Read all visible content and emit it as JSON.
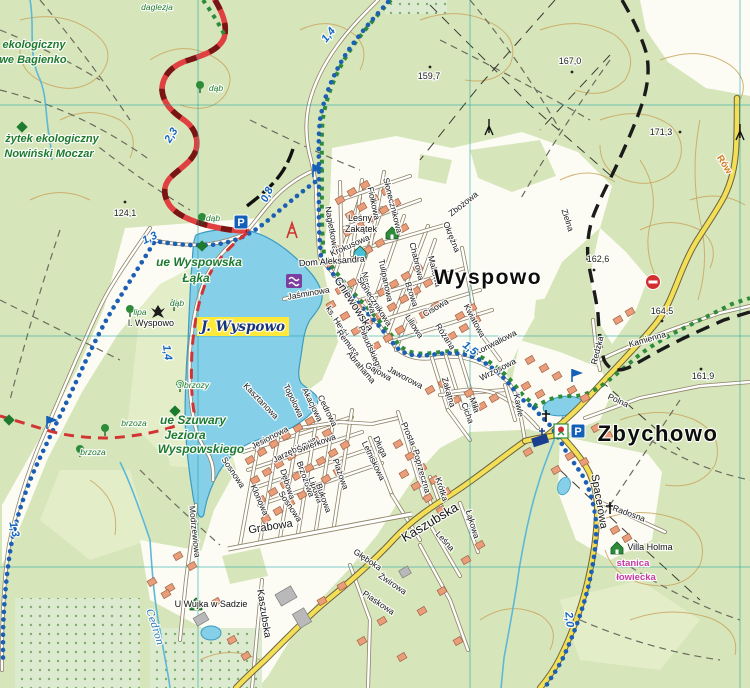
{
  "towns": [
    {
      "name": "Wyspowo",
      "x": 488,
      "y": 284,
      "fs": 21
    },
    {
      "name": "Zbychowo",
      "x": 658,
      "y": 441,
      "fs": 22
    }
  ],
  "streets": [
    {
      "n": "Zbożowa",
      "x": 465,
      "y": 206,
      "r": -38
    },
    {
      "n": "Okrężna",
      "x": 449,
      "y": 238,
      "r": 68
    },
    {
      "n": "Zielna",
      "x": 565,
      "y": 221,
      "r": 72
    },
    {
      "n": "Słonecznikowa",
      "x": 390,
      "y": 206,
      "r": 76
    },
    {
      "n": "Fiołkowa",
      "x": 371,
      "y": 204,
      "r": 78
    },
    {
      "n": "Nagietkowa",
      "x": 329,
      "y": 229,
      "r": 80
    },
    {
      "n": "Krokusowa",
      "x": 351,
      "y": 248,
      "r": -24
    },
    {
      "n": "Chabrowa",
      "x": 414,
      "y": 262,
      "r": 76
    },
    {
      "n": "Makowa",
      "x": 432,
      "y": 272,
      "r": 76
    },
    {
      "n": "Tulipanowa",
      "x": 383,
      "y": 281,
      "r": 78
    },
    {
      "n": "Narcyzowa",
      "x": 366,
      "y": 293,
      "r": 78
    },
    {
      "n": "Bzowa",
      "x": 409,
      "y": 295,
      "r": 72
    },
    {
      "n": "Gniewowska",
      "x": 351,
      "y": 306,
      "r": 57,
      "fs": 11
    },
    {
      "n": "Słonecznikowa",
      "x": 372,
      "y": 303,
      "r": 57
    },
    {
      "n": "Jaśminowa",
      "x": 309,
      "y": 296,
      "r": -10
    },
    {
      "n": "ks. Heyki",
      "x": 335,
      "y": 323,
      "r": 57
    },
    {
      "n": "Piłsudskiego",
      "x": 368,
      "y": 349,
      "r": 66
    },
    {
      "n": "Remusa",
      "x": 346,
      "y": 345,
      "r": 52
    },
    {
      "n": "Abrahama",
      "x": 359,
      "y": 369,
      "r": 50
    },
    {
      "n": "Gajowa",
      "x": 377,
      "y": 374,
      "r": 30
    },
    {
      "n": "Jaworowa",
      "x": 404,
      "y": 380,
      "r": 28
    },
    {
      "n": "Cisowa",
      "x": 437,
      "y": 310,
      "r": -30
    },
    {
      "n": "Liliowa",
      "x": 412,
      "y": 328,
      "r": 57
    },
    {
      "n": "Różana",
      "x": 443,
      "y": 338,
      "r": 57
    },
    {
      "n": "Kwiatowa",
      "x": 472,
      "y": 322,
      "r": 62
    },
    {
      "n": "Konwaliowa",
      "x": 497,
      "y": 345,
      "r": -27
    },
    {
      "n": "Wrzosowa",
      "x": 499,
      "y": 372,
      "r": -27
    },
    {
      "n": "Zakątna",
      "x": 446,
      "y": 393,
      "r": 74
    },
    {
      "n": "Miła",
      "x": 472,
      "y": 406,
      "r": 70
    },
    {
      "n": "Cicha",
      "x": 465,
      "y": 414,
      "r": 70
    },
    {
      "n": "Kawle",
      "x": 516,
      "y": 406,
      "r": 78
    },
    {
      "n": "Kasztanowa",
      "x": 259,
      "y": 403,
      "r": 46
    },
    {
      "n": "Topolowa",
      "x": 291,
      "y": 402,
      "r": 64
    },
    {
      "n": "Akacjowa",
      "x": 310,
      "y": 406,
      "r": 64
    },
    {
      "n": "Cedrowa",
      "x": 325,
      "y": 412,
      "r": 64
    },
    {
      "n": "Jesionowa",
      "x": 271,
      "y": 440,
      "r": -27
    },
    {
      "n": "Jarzębinowa",
      "x": 296,
      "y": 452,
      "r": -27
    },
    {
      "n": "Świerkowa",
      "x": 317,
      "y": 446,
      "r": -20
    },
    {
      "n": "Sosnowa",
      "x": 231,
      "y": 474,
      "r": 56
    },
    {
      "n": "Klonowa",
      "x": 257,
      "y": 501,
      "r": 66
    },
    {
      "n": "Dębowa",
      "x": 285,
      "y": 485,
      "r": 72
    },
    {
      "n": "Brzozowa",
      "x": 303,
      "y": 480,
      "r": 70
    },
    {
      "n": "Lipowa",
      "x": 313,
      "y": 491,
      "r": 70
    },
    {
      "n": "Bukowa",
      "x": 321,
      "y": 499,
      "r": 70
    },
    {
      "n": "Plażowa",
      "x": 338,
      "y": 475,
      "r": 70
    },
    {
      "n": "Sosnowa",
      "x": 288,
      "y": 508,
      "r": 56
    },
    {
      "n": "Grabowa",
      "x": 271,
      "y": 530,
      "r": -9,
      "fs": 11
    },
    {
      "n": "Modrzewiowa",
      "x": 192,
      "y": 532,
      "r": 84
    },
    {
      "n": "Długa",
      "x": 378,
      "y": 448,
      "r": 64
    },
    {
      "n": "Letniskowa",
      "x": 371,
      "y": 462,
      "r": 64
    },
    {
      "n": "Prosta",
      "x": 406,
      "y": 435,
      "r": 66
    },
    {
      "n": "Poprzeczna",
      "x": 419,
      "y": 472,
      "r": 74
    },
    {
      "n": "Krótka",
      "x": 439,
      "y": 490,
      "r": 72
    },
    {
      "n": "Kaszubska",
      "x": 432,
      "y": 526,
      "r": -31,
      "fs": 13
    },
    {
      "n": "Łąkowa",
      "x": 470,
      "y": 525,
      "r": 73
    },
    {
      "n": "Leśna",
      "x": 443,
      "y": 543,
      "r": 48
    },
    {
      "n": "Kaszubska",
      "x": 261,
      "y": 614,
      "r": 81,
      "fs": 10
    },
    {
      "n": "Głęboka",
      "x": 366,
      "y": 562,
      "r": 34
    },
    {
      "n": "Żwirowa",
      "x": 391,
      "y": 586,
      "r": 34
    },
    {
      "n": "Piaskowa",
      "x": 377,
      "y": 605,
      "r": 34
    },
    {
      "n": "Spacerowa",
      "x": 596,
      "y": 502,
      "r": 80,
      "fs": 11
    },
    {
      "n": "Radosna",
      "x": 628,
      "y": 516,
      "r": 20
    },
    {
      "n": "Polna",
      "x": 617,
      "y": 403,
      "r": 24
    },
    {
      "n": "Kamienna",
      "x": 648,
      "y": 342,
      "r": -16
    },
    {
      "n": "Redzka",
      "x": 600,
      "y": 351,
      "r": -76
    }
  ],
  "nature": [
    {
      "t": "ekologiczny",
      "x": 34,
      "y": 48,
      "fs": 11
    },
    {
      "t": "we Bagienko",
      "x": 33,
      "y": 63,
      "fs": 11
    },
    {
      "t": "żytek ekologiczny",
      "x": 52,
      "y": 142,
      "fs": 11
    },
    {
      "t": "Nowiński Moczar",
      "x": 49,
      "y": 157,
      "fs": 11
    },
    {
      "t": "ue Wyspowska",
      "x": 199,
      "y": 266,
      "fs": 12
    },
    {
      "t": "Łąka",
      "x": 196,
      "y": 282,
      "fs": 12
    },
    {
      "t": "ue Szuwary",
      "x": 193,
      "y": 424,
      "fs": 12
    },
    {
      "t": "Jeziora",
      "x": 185,
      "y": 439,
      "fs": 12
    },
    {
      "t": "Wyspowskiego",
      "x": 201,
      "y": 453,
      "fs": 12
    }
  ],
  "trees": [
    {
      "t": "daglezja",
      "x": 157,
      "y": 10
    },
    {
      "t": "dąb",
      "x": 216,
      "y": 91
    },
    {
      "t": "dąb",
      "x": 213,
      "y": 221
    },
    {
      "t": "lipa",
      "x": 140,
      "y": 315
    },
    {
      "t": "dąb",
      "x": 177,
      "y": 306
    },
    {
      "t": "3 brzozy",
      "x": 193,
      "y": 388
    },
    {
      "t": "brzoza",
      "x": 134,
      "y": 426
    },
    {
      "t": "brzoza",
      "x": 93,
      "y": 455
    }
  ],
  "poi": [
    {
      "t": "Leśny",
      "x": 360,
      "y": 221
    },
    {
      "t": "Zakątek",
      "x": 361,
      "y": 232
    },
    {
      "t": "Dom Aleksandra",
      "x": 332,
      "y": 264,
      "r": -4
    },
    {
      "t": "l. Wyspowo",
      "x": 151,
      "y": 326
    },
    {
      "t": "U Wujka w Sadzie",
      "x": 211,
      "y": 607
    },
    {
      "t": "Villa Holma",
      "x": 650,
      "y": 550
    }
  ],
  "water_labels": [
    {
      "t": "J. Wyspowo",
      "x": 243,
      "y": 331,
      "bg": 1
    },
    {
      "t": "Cedron",
      "x": 152,
      "y": 628,
      "r": 72
    }
  ],
  "other_labels": [
    {
      "t": "stanica",
      "x": 633,
      "y": 566,
      "c": "#c73aa4"
    },
    {
      "t": "łowiecka",
      "x": 636,
      "y": 580,
      "c": "#c73aa4"
    },
    {
      "t": "Rów",
      "x": 722,
      "y": 166,
      "r": 58,
      "c": "#d4791f"
    }
  ],
  "heights": [
    {
      "v": "124,1",
      "x": 125,
      "y": 216,
      "dx": 0,
      "dy": -14
    },
    {
      "v": "159,7",
      "x": 429,
      "y": 79,
      "dx": 1,
      "dy": -12
    },
    {
      "v": "167,0",
      "x": 570,
      "y": 64,
      "dx": 2,
      "dy": 8
    },
    {
      "v": "171,3",
      "x": 661,
      "y": 135,
      "dx": 19,
      "dy": -3
    },
    {
      "v": "162,6",
      "x": 598,
      "y": 262,
      "dx": -4,
      "dy": 8
    },
    {
      "v": "164,5",
      "x": 662,
      "y": 314,
      "dx": 0,
      "dy": 7
    },
    {
      "v": "161,9",
      "x": 703,
      "y": 379,
      "dx": -2,
      "dy": -10
    }
  ],
  "markers": [
    {
      "v": "1,4",
      "x": 331,
      "y": 37,
      "r": -52
    },
    {
      "v": "2,3",
      "x": 174,
      "y": 137,
      "r": -58
    },
    {
      "v": "0,8",
      "x": 270,
      "y": 196,
      "r": -65
    },
    {
      "v": "1,3",
      "x": 151,
      "y": 241,
      "r": -25
    },
    {
      "v": "1,4",
      "x": 164,
      "y": 353,
      "r": 82
    },
    {
      "v": "1,5",
      "x": 468,
      "y": 351,
      "r": 38
    },
    {
      "v": "1,3",
      "x": 11,
      "y": 530,
      "r": 78
    },
    {
      "v": "2,0",
      "x": 566,
      "y": 620,
      "r": 84
    }
  ],
  "icons": [
    {
      "t": "parking",
      "x": 241,
      "y": 222
    },
    {
      "t": "parking",
      "x": 578,
      "y": 431
    },
    {
      "t": "flag",
      "x": 313,
      "y": 174
    },
    {
      "t": "flag",
      "x": 572,
      "y": 379
    },
    {
      "t": "flag",
      "x": 47,
      "y": 426
    },
    {
      "t": "swim",
      "x": 294,
      "y": 281
    },
    {
      "t": "agro",
      "x": 392,
      "y": 233
    },
    {
      "t": "agro",
      "x": 196,
      "y": 604
    },
    {
      "t": "agro",
      "x": 617,
      "y": 548
    },
    {
      "t": "hostel",
      "x": 360,
      "y": 252
    },
    {
      "t": "tower",
      "x": 292,
      "y": 231
    },
    {
      "t": "landmark",
      "x": 158,
      "y": 312
    },
    {
      "t": "shrine",
      "x": 561,
      "y": 431
    },
    {
      "t": "church",
      "x": 540,
      "y": 440
    },
    {
      "t": "cross",
      "x": 546,
      "y": 416
    },
    {
      "t": "cross",
      "x": 610,
      "y": 508
    },
    {
      "t": "noentry",
      "x": 653,
      "y": 282
    },
    {
      "t": "mast",
      "x": 489,
      "y": 128
    },
    {
      "t": "mast",
      "x": 740,
      "y": 133
    },
    {
      "t": "diamond",
      "x": 22,
      "y": 127
    },
    {
      "t": "diamond",
      "x": 202,
      "y": 246
    },
    {
      "t": "diamond",
      "x": 175,
      "y": 411
    },
    {
      "t": "diamond",
      "x": 9,
      "y": 420
    },
    {
      "t": "tree",
      "x": 200,
      "y": 88
    },
    {
      "t": "tree",
      "x": 202,
      "y": 220
    },
    {
      "t": "tree",
      "x": 130,
      "y": 312
    },
    {
      "t": "tree",
      "x": 174,
      "y": 306
    },
    {
      "t": "tree",
      "x": 180,
      "y": 387
    },
    {
      "t": "tree",
      "x": 105,
      "y": 431
    },
    {
      "t": "tree",
      "x": 80,
      "y": 452
    }
  ],
  "glyphs": {
    "parking": "P"
  },
  "colors": {
    "forest": "#d7e6ba",
    "meadow": "#e4eecb",
    "open": "#fcfcf4",
    "water": "#86cfe8",
    "water_edge": "#3a9cc0",
    "road_yellow": "#f2df55",
    "road_casing": "#8f8468",
    "trail_red": "#d23333",
    "trail_blue": "#1d5fb2",
    "trail_green": "#2e8b3a",
    "trail_black": "#1b1b1b",
    "building": "#e99d79",
    "building_edge": "#a2664a",
    "building_gray": "#b9b9b9",
    "contour": "#c9a45f",
    "grid": "#17a3a3",
    "lake_label_bg": "#ffe93b",
    "lake_label_fg": "#16337f"
  }
}
